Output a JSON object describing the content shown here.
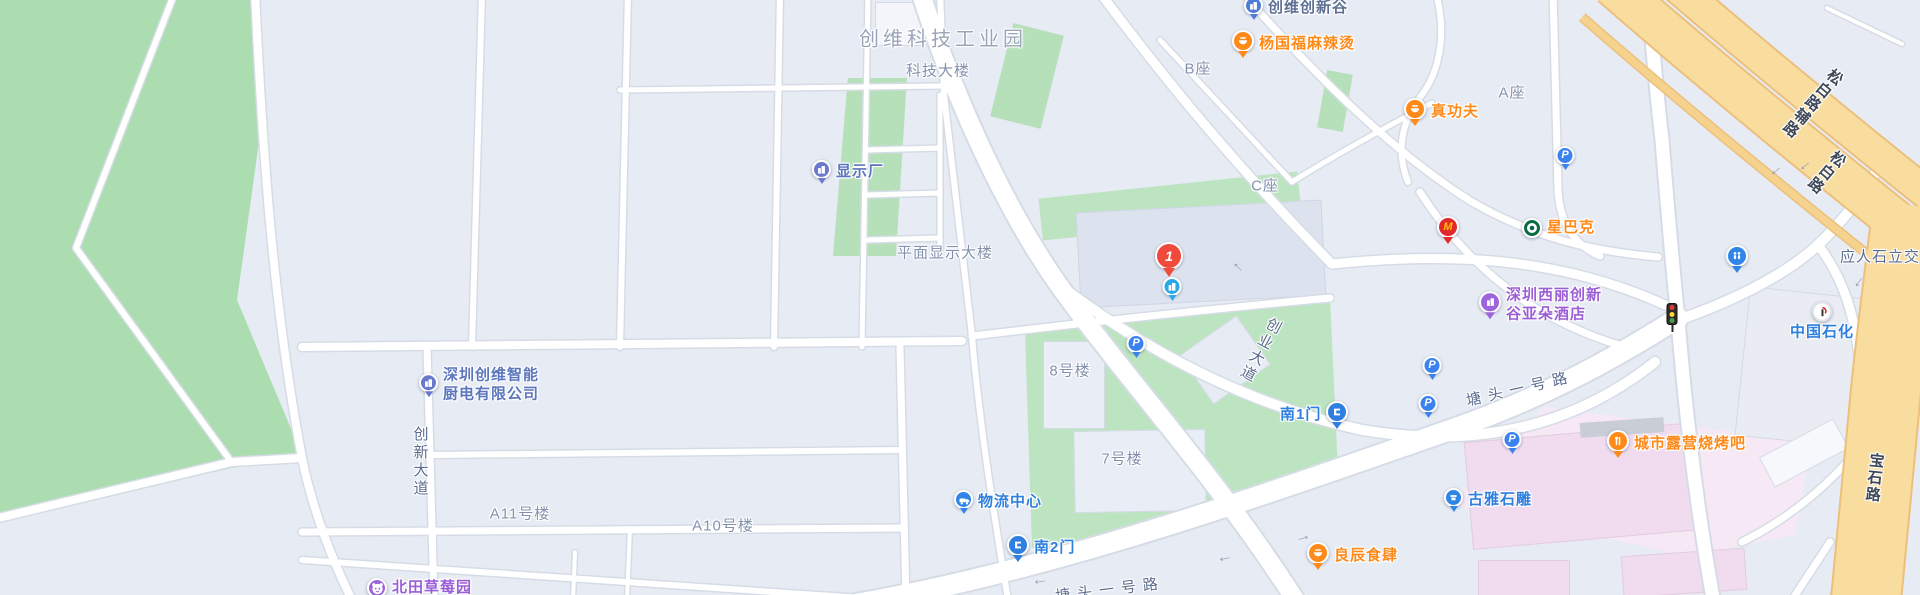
{
  "regions": {
    "industrial_park": "创维科技工业园",
    "tech_building": "科技大楼",
    "flat_display_building": "平面显示大楼",
    "block_b": "B座",
    "block_c": "C座",
    "block_a": "A座",
    "building_8": "8号楼",
    "building_7": "7号楼",
    "building_a11": "A11号楼",
    "building_a10": "A10号楼"
  },
  "roads": {
    "chuangxin_avenue": "创新大道",
    "chuangye_avenue": "创业大道",
    "tangtou_no1_mid": "塘头一号路",
    "tangtou_no1_bottom": "塘头一号路",
    "songbai_service": "松白路辅路",
    "songbai": "松白路",
    "baoshi": "宝石路",
    "yingrenshi_interchange": "应人石立交"
  },
  "pois": {
    "skyworth_innovation_valley": "创维创新谷",
    "yangguofu_malatang": "杨国福麻辣烫",
    "zhengongfu": "真功夫",
    "starbucks": "星巴克",
    "display_factory": "显示厂",
    "atour_hotel": [
      "深圳西丽创新",
      "谷亚朵酒店"
    ],
    "skyworth_kitchen": [
      "深圳创维智能",
      "厨电有限公司"
    ],
    "logistics_center": "物流中心",
    "south_gate_2": "南2门",
    "south_gate_1": "南1门",
    "strawberry_farm": "北田草莓园",
    "city_camping_bbq": "城市露营烧烤吧",
    "guya_stone_carving": "古雅石雕",
    "liangchen_restaurant": "良辰食肆",
    "sinopec": "中国石化"
  },
  "marker": {
    "label": "1"
  },
  "glyphs": {
    "parking": "P",
    "mcdonalds": "M",
    "arrow": "→"
  },
  "colors": {
    "poi_orange": "#ff8a1a",
    "poi_blue": "#5b76bd",
    "gate_blue": "#2f7fe0",
    "poi_purple": "#9b5ed6",
    "marker_red": "#f04a3c",
    "park_green": "#abddb0",
    "campus_green": "#bce4c0",
    "highway_orange": "#f9dd9e",
    "commercial_pink": "#f6e8f4"
  }
}
